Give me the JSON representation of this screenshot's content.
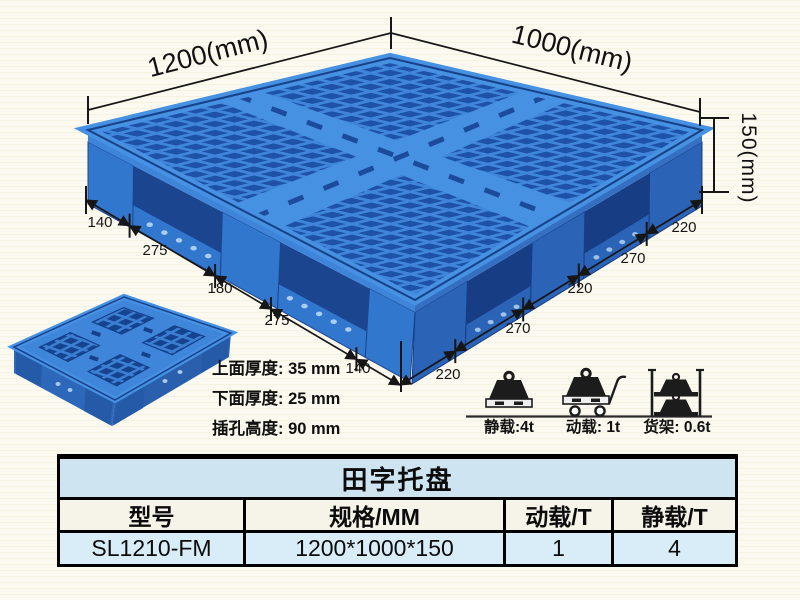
{
  "pallet_drawing": {
    "length_label": "1200(mm)",
    "width_label": "1000(mm)",
    "height_label": "150(mm)",
    "width_edge_segments": [
      "140",
      "275",
      "180",
      "275",
      "140"
    ],
    "length_edge_segments": [
      "220",
      "270",
      "220",
      "270",
      "220"
    ],
    "thickness_notes": {
      "top": "上面厚度: 35 mm",
      "bottom": "下面厚度: 25 mm",
      "slot": "插孔高度: 90 mm"
    },
    "colors": {
      "pallet_light_blue": "#3f86da",
      "pallet_dark_blue": "#1e52a8"
    }
  },
  "load_ratings": [
    {
      "icon": "static-load-icon",
      "label": "静载:4t"
    },
    {
      "icon": "dynamic-load-icon",
      "label": "动载: 1t"
    },
    {
      "icon": "rack-load-icon",
      "label": "货架: 0.6t"
    }
  ],
  "spec_table": {
    "title": "田字托盘",
    "headers": [
      "型号",
      "规格/MM",
      "动载/T",
      "静载/T"
    ],
    "row": {
      "model": "SL1210-FM",
      "spec_mm": "1200*1000*150",
      "dynamic_load_t": "1",
      "static_load_t": "4"
    },
    "title_bg": "#cfe4f1",
    "row_bg": "#d9edf8"
  }
}
